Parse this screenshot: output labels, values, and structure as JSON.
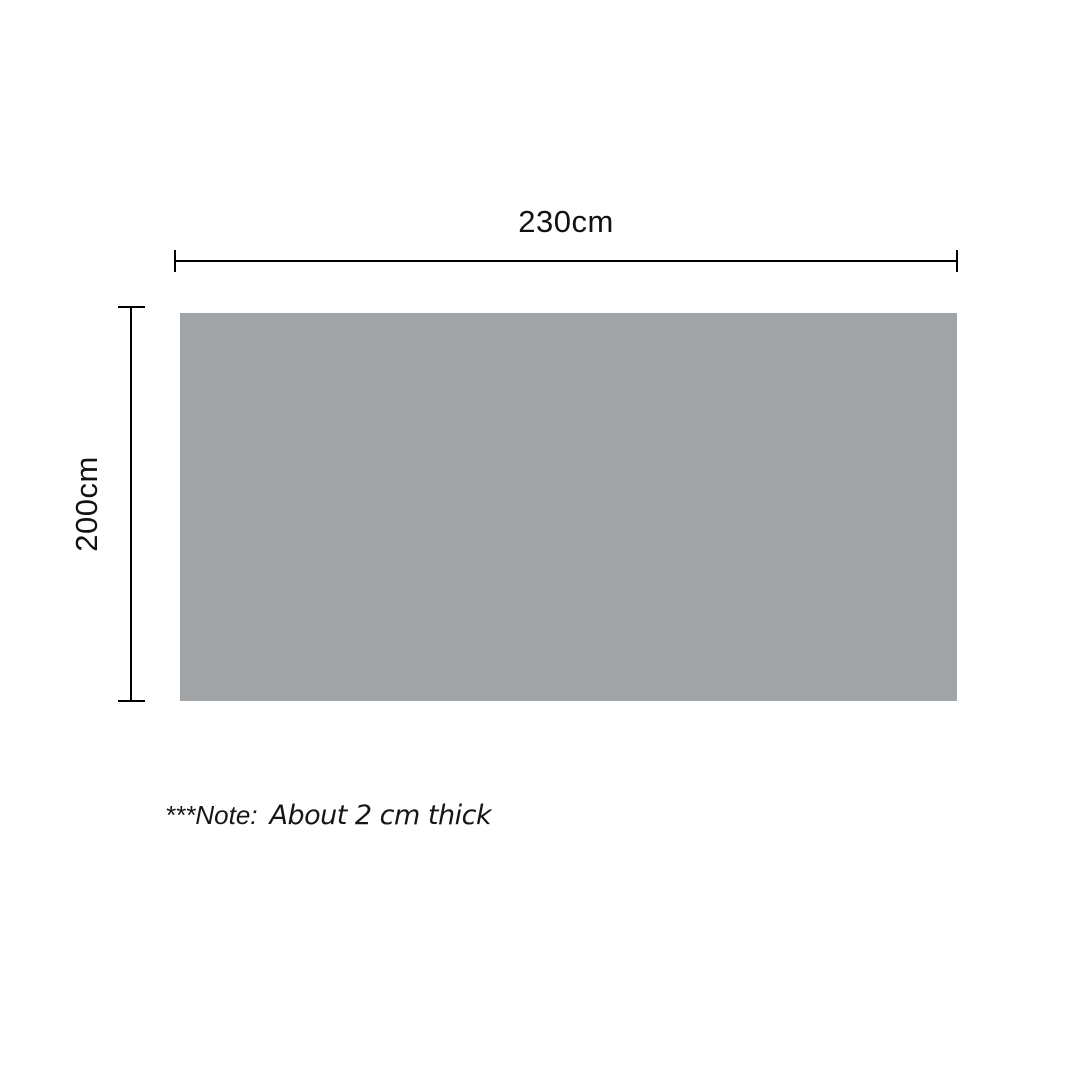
{
  "diagram": {
    "width_label": "230cm",
    "height_label": "200cm",
    "colors": {
      "surface": "#A2A5A8",
      "line": "#000000",
      "text": "#111111",
      "background": "#FFFFFF"
    }
  },
  "note": {
    "prefix": "***Note:",
    "text": "About 2 cm thick"
  }
}
